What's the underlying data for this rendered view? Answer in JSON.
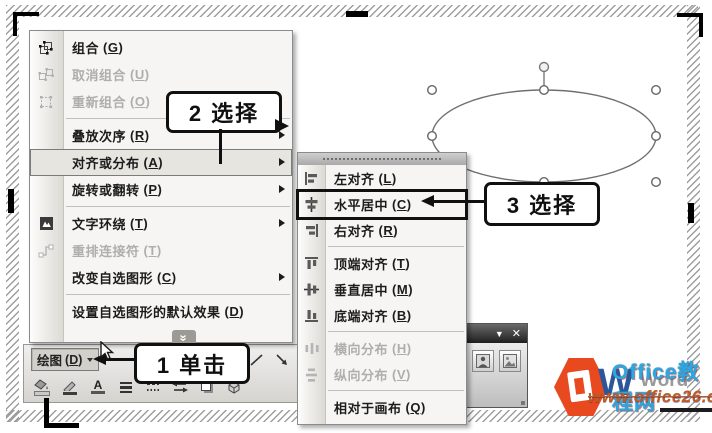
{
  "menu": {
    "items": [
      {
        "label": "组合",
        "key": "G"
      },
      {
        "label": "取消组合",
        "key": "U"
      },
      {
        "label": "重新组合",
        "key": "O"
      },
      {
        "label": "叠放次序",
        "key": "R"
      },
      {
        "label": "对齐或分布",
        "key": "A"
      },
      {
        "label": "旋转或翻转",
        "key": "P"
      },
      {
        "label": "文字环绕",
        "key": "T"
      },
      {
        "label": "重排连接符",
        "key": "T"
      },
      {
        "label": "改变自选图形",
        "key": "C"
      },
      {
        "label": "设置自选图形的默认效果",
        "key": "D"
      }
    ]
  },
  "submenu": {
    "items": [
      {
        "label": "左对齐",
        "key": "L"
      },
      {
        "label": "水平居中",
        "key": "C"
      },
      {
        "label": "右对齐",
        "key": "R"
      },
      {
        "label": "顶端对齐",
        "key": "T"
      },
      {
        "label": "垂直居中",
        "key": "M"
      },
      {
        "label": "底端对齐",
        "key": "B"
      },
      {
        "label": "横向分布",
        "key": "H"
      },
      {
        "label": "纵向分布",
        "key": "V"
      },
      {
        "label": "相对于画布",
        "key": "Q"
      }
    ]
  },
  "callouts": {
    "step1": "1 单击",
    "step2": "2 选择",
    "step3": "3 选择"
  },
  "toolbar": {
    "draw_label": "绘图",
    "draw_key": "D",
    "font_color_letter": "A"
  },
  "picture_toolbar": {
    "collapse_icon": "▼",
    "close_icon": "✕"
  },
  "watermark": {
    "word_initial": "W",
    "word_text": "Word",
    "site_name": "Office教程网",
    "site_url": "www.office26.com"
  },
  "colors": {
    "office_orange": "#E8491F",
    "word_blue": "#2B579A",
    "site_cyan": "#2BA8DF",
    "url_orange": "#C05A1E"
  }
}
